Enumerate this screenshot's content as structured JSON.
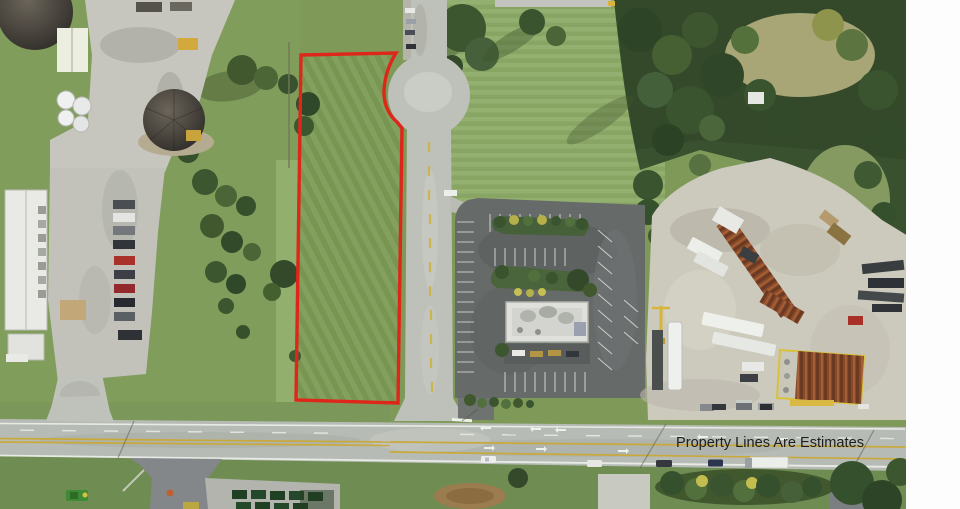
{
  "annotation": {
    "disclaimer_text": "Property Lines Are Estimates"
  },
  "colors": {
    "property_line_red": "#df261b",
    "disclaimer_color": "#1e1e1e",
    "photo_border_white": "#fdfdfd",
    "grass_base": "#7f9a58",
    "grass_light": "#8fac68",
    "tree_green": "#3c5630",
    "road_gray": "#bec1ba",
    "asphalt_dark": "#65696a",
    "concrete_light": "#cecbbf",
    "rust_brown": "#8a4a2a",
    "lane_yellow": "#c9a93c",
    "marking_white": "#f0f1ec"
  }
}
